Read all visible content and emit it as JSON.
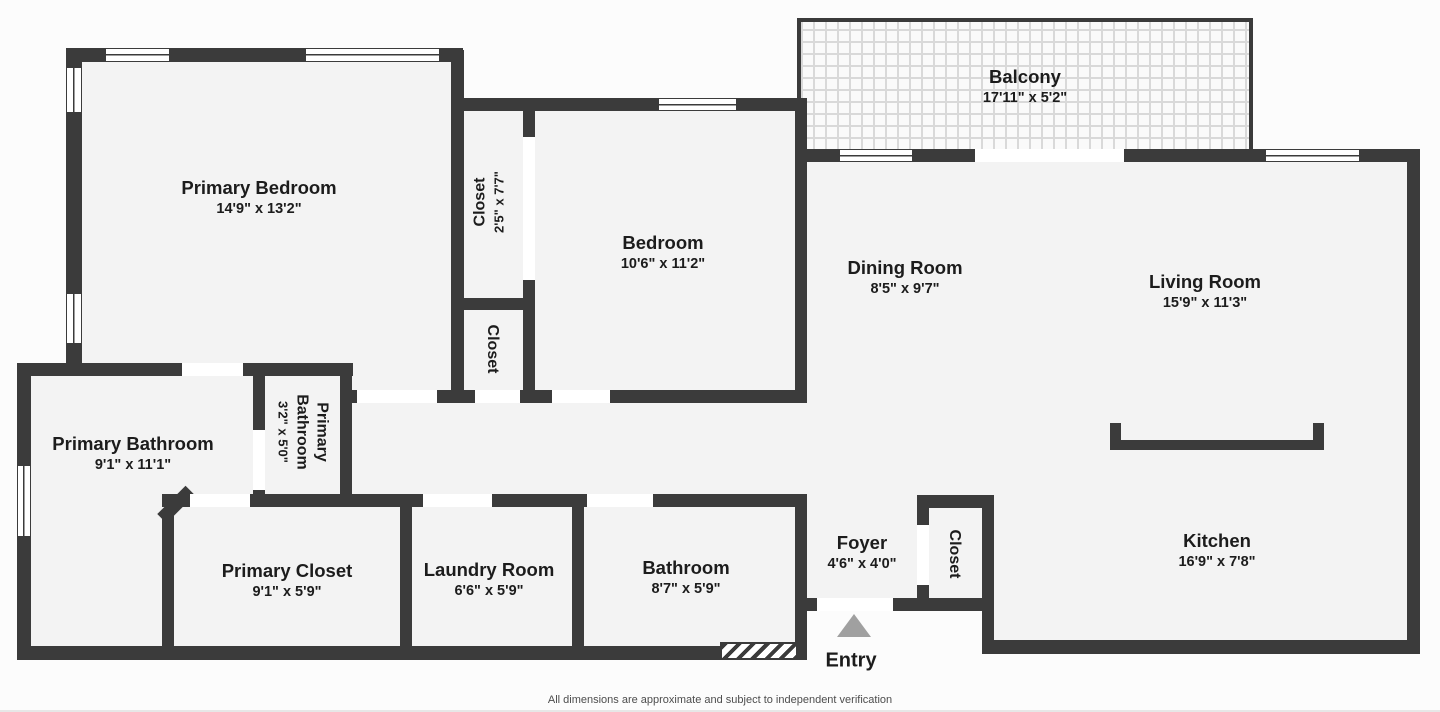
{
  "plan": {
    "footer": "All dimensions are approximate and subject to independent verification",
    "entry_label": "Entry",
    "colors": {
      "wall": "#3b3b3b",
      "floor": "#f3f3f3",
      "background": "#fcfcfc",
      "entry_arrow": "#a0a0a0",
      "balcony_grout": "#d9d9d9"
    },
    "rooms": {
      "primary_bedroom": {
        "name": "Primary Bedroom",
        "dims": "14'9\" x 13'2\""
      },
      "closet_tall": {
        "name": "Closet",
        "dims": "2'5\" x 7'7\""
      },
      "closet_small": {
        "name": "Closet"
      },
      "bedroom": {
        "name": "Bedroom",
        "dims": "10'6\" x 11'2\""
      },
      "balcony": {
        "name": "Balcony",
        "dims": "17'11\" x 5'2\""
      },
      "dining_room": {
        "name": "Dining Room",
        "dims": "8'5\" x 9'7\""
      },
      "living_room": {
        "name": "Living Room",
        "dims": "15'9\" x 11'3\""
      },
      "primary_bathroom": {
        "name": "Primary Bathroom",
        "dims": "9'1\" x 11'1\""
      },
      "primary_bathroom_small": {
        "name": "Primary\nBathroom",
        "dims": "3'2\" x 5'0\""
      },
      "primary_closet": {
        "name": "Primary Closet",
        "dims": "9'1\" x 5'9\""
      },
      "laundry_room": {
        "name": "Laundry Room",
        "dims": "6'6\" x 5'9\""
      },
      "bathroom": {
        "name": "Bathroom",
        "dims": "8'7\" x 5'9\""
      },
      "foyer": {
        "name": "Foyer",
        "dims": "4'6\" x 4'0\""
      },
      "foyer_closet": {
        "name": "Closet"
      },
      "kitchen": {
        "name": "Kitchen",
        "dims": "16'9\" x 7'8\""
      }
    }
  }
}
